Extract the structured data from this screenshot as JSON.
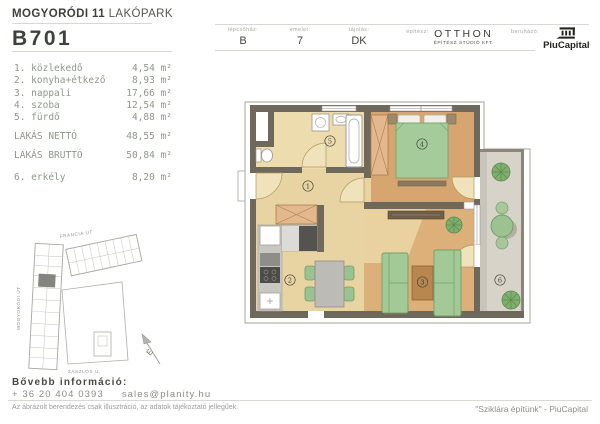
{
  "header": {
    "project_bold": "MOGYORÓDI 11",
    "project_light": "LAKÓPARK",
    "unit_id": "B701",
    "fields": [
      {
        "label": "lépcsőház:",
        "value": "B"
      },
      {
        "label": "emelet:",
        "value": "7"
      },
      {
        "label": "tájolás:",
        "value": "DK"
      },
      {
        "label": "építész:",
        "value": "OTTHON",
        "value2": "ÉPÍTÉSZ STÚDIÓ KFT."
      },
      {
        "label": "beruházó:"
      }
    ],
    "developer": "PiuCapital"
  },
  "rooms": {
    "items": [
      {
        "label": "1. közlekedő",
        "area": "4,54 m²"
      },
      {
        "label": "2. konyha+étkező",
        "area": "8,93 m²"
      },
      {
        "label": "3. nappali",
        "area": "17,66 m²"
      },
      {
        "label": "4. szoba",
        "area": "12,54 m²"
      },
      {
        "label": "5. fürdő",
        "area": "4,88 m²"
      }
    ],
    "net": {
      "label": "LAKÁS NETTÓ",
      "area": "48,55 m²"
    },
    "gross": {
      "label": "LAKÁS BRUTTÓ",
      "area": "50,84 m²"
    },
    "balcony": {
      "label": "6. erkély",
      "area": "8,20 m²"
    }
  },
  "plan": {
    "room_numbers": [
      "1",
      "2",
      "3",
      "4",
      "5",
      "6"
    ],
    "colors": {
      "wall": "#6f695c",
      "pale_floor": "#e9d8a9",
      "wood_floor": "#d7a56f",
      "balcony_floor": "#d7d3c8",
      "furniture_green": "#a3c997"
    }
  },
  "site": {
    "street_top": "FRANCIA ÚT",
    "street_left": "MOGYORÓDI ÚT",
    "street_bottom": "ZÁSZLÓS U.",
    "north": "É"
  },
  "contact": {
    "heading": "Bővebb információ:",
    "phone": "+ 36 20 404 0393",
    "email": "sales@planity.hu"
  },
  "footer": {
    "disclaimer": "Az ábrázolt berendezés csak illusztráció, az adatok tájékoztató jellegűek.",
    "quote": "\"Sziklára építünk\" - PiuCapital"
  }
}
